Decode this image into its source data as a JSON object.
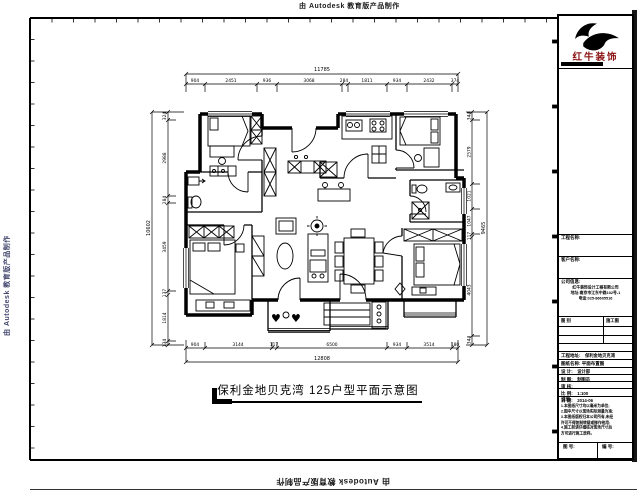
{
  "sheet": {
    "watermark": "由 Autodesk 教育版产品制作"
  },
  "drawing": {
    "title": "保利金地贝克湾 125户型平面示意图",
    "symbols": {
      "heart": "♥"
    },
    "dims": {
      "top": {
        "total": "11785",
        "segments": [
          "904",
          "2451",
          "936",
          "3068",
          "284",
          "1811",
          "934",
          "2432",
          "374"
        ]
      },
      "bottom": {
        "total": "12808",
        "segments": [
          "904",
          "3144",
          "117",
          "6500",
          "934",
          "3514",
          "180"
        ]
      },
      "left": {
        "total": "10602",
        "segments": [
          "324",
          "2988",
          "284",
          "3459",
          "137",
          "1814",
          "134"
        ]
      },
      "right": {
        "total": "9465",
        "segments": [
          "344",
          "2579",
          "1021",
          "1047",
          "117",
          "4043",
          "344"
        ]
      }
    }
  },
  "title_block": {
    "brand": "红牛装饰",
    "brand_color": "#8a1010",
    "fields": [
      {
        "label": "工程名称:"
      },
      {
        "label": "客户名称:"
      },
      {
        "label": "公司信息:"
      }
    ],
    "company_lines": [
      "红牛装饰设计工程有限公司",
      "地址:南京市江东中路102号-1",
      "电话:025-86605516"
    ],
    "table": {
      "rows": [
        [
          "图 别",
          "施工图"
        ]
      ]
    },
    "rows2": [
      {
        "label": "工程地址:",
        "value": "保利金地贝克湾"
      },
      {
        "label": "图纸名称: 平面布置图",
        "value": ""
      },
      {
        "label": "设 计:",
        "value": "设计部"
      },
      {
        "label": "制 图:",
        "value": "制图员"
      },
      {
        "label": "审 核:",
        "value": ""
      },
      {
        "label": "比 例:",
        "value": "1:100"
      },
      {
        "label": "日 期:",
        "value": "2014-06"
      }
    ],
    "notes_title": "说明:",
    "notes": [
      "1.本图纸尺寸均以毫米为单位;",
      "2.图中尺寸以现场实际测量为准;",
      "3.本图纸版权归本公司所有,未经",
      "许可不得复制转载或挪作他用;",
      "4.施工前请仔细核对现场尺寸后",
      "方可进行施工放样。"
    ],
    "footer_cells": [
      {
        "label": "图 号:"
      },
      {
        "label": "编 号:"
      }
    ]
  }
}
